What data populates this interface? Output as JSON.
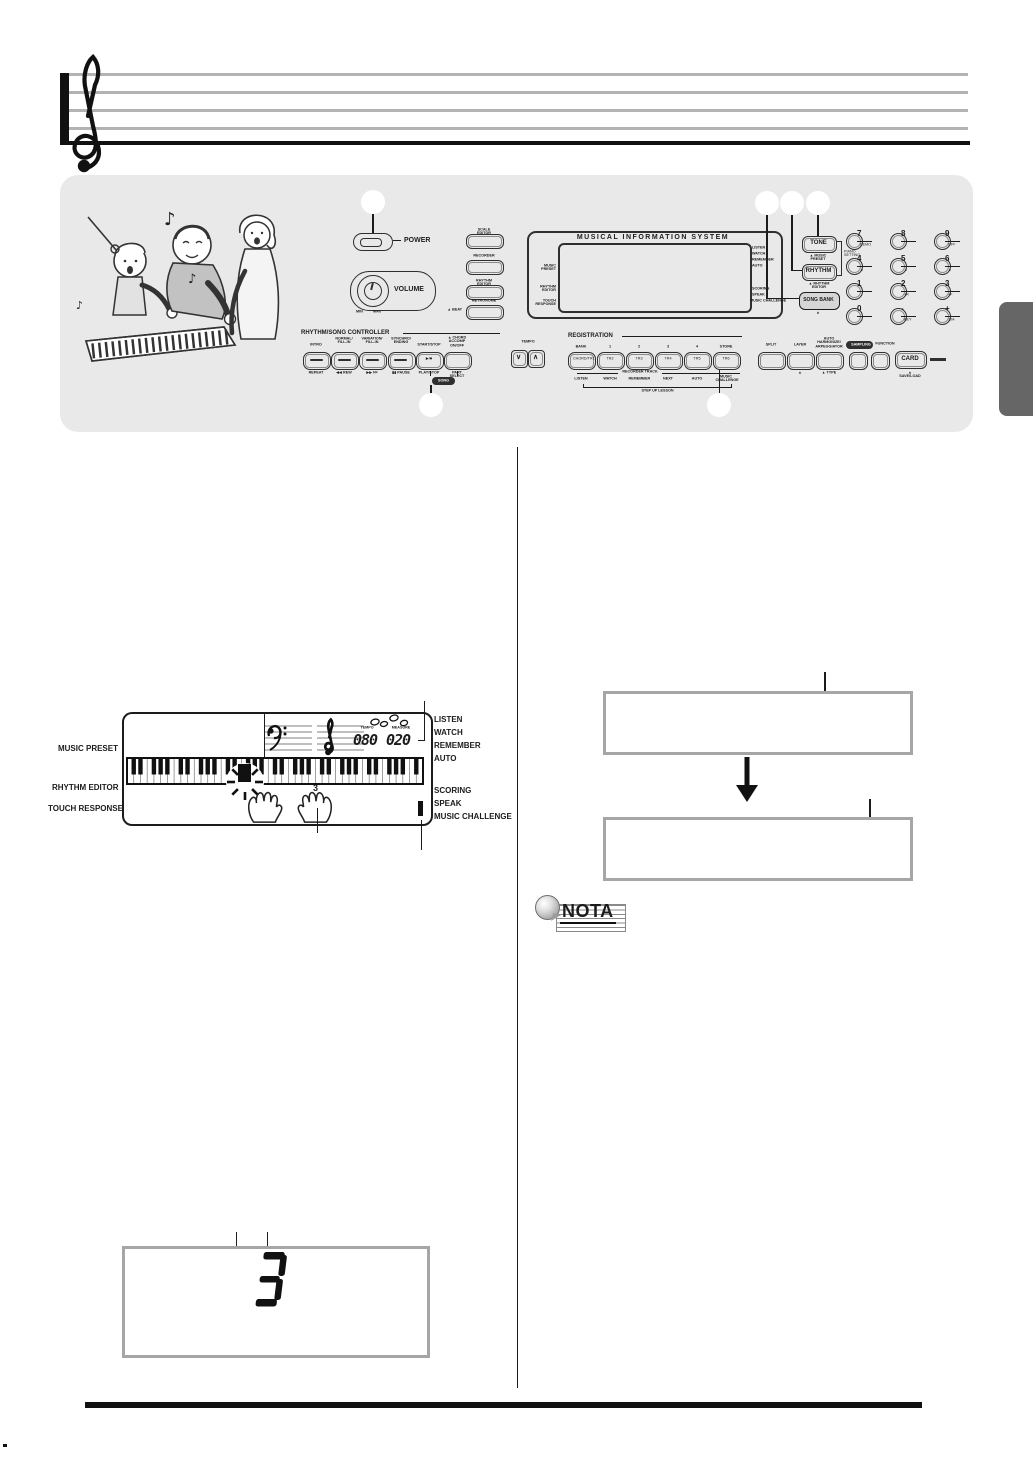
{
  "colors": {
    "panel_bg": "#e9e9e9",
    "side_tab": "#666666",
    "box_border": "#a6a6a6",
    "ink": "#1c1c1c"
  },
  "panel": {
    "power_label": "POWER",
    "volume": {
      "label": "VOLUME",
      "min": "MIN",
      "max": "MAX"
    },
    "side_buttons": [
      {
        "label": "SCALE EDITOR"
      },
      {
        "label": "RECORDER"
      },
      {
        "label": "RHYTHM EDITOR"
      },
      {
        "label": "METRONOME"
      }
    ],
    "beat_sub": "▲ BEAT",
    "display": {
      "title": "MUSICAL INFORMATION SYSTEM",
      "left_labels": [
        "MUSIC PRESET",
        "RHYTHM EDITOR",
        "TOUCH RESPONSE"
      ],
      "right_top_labels": [
        "LISTEN",
        "WATCH",
        "REMEMBER",
        "AUTO"
      ],
      "right_bottom_labels": [
        "SCORING",
        "SPEAK",
        "MUSIC CHALLENGE"
      ]
    },
    "tone": {
      "label": "TONE",
      "sub": "▲ MUSIC PRESET"
    },
    "rhythm": {
      "label": "RHYTHM",
      "sub": "▲ RHYTHM EDITOR"
    },
    "piano_setting": "PIANO\nSETTING",
    "song_bank": {
      "label": "SONG BANK",
      "sub": "▲"
    },
    "numpad": {
      "cells": [
        {
          "n": "7",
          "s": "DEMO"
        },
        {
          "n": "8",
          "s": ""
        },
        {
          "n": "9",
          "s": "OFF"
        },
        {
          "n": "4",
          "s": "▲"
        },
        {
          "n": "5",
          "s": "▲"
        },
        {
          "n": "6",
          "s": "▲"
        },
        {
          "n": "1",
          "s": ""
        },
        {
          "n": "2",
          "s": "+R"
        },
        {
          "n": "3",
          "s": "+F"
        },
        {
          "n": "0",
          "s": ""
        },
        {
          "n": "-",
          "s": "KEY"
        },
        {
          "n": "+",
          "s": "10A"
        }
      ]
    },
    "tempo": {
      "label": "TEMPO",
      "down": "∨",
      "up": "∧"
    },
    "controller": {
      "title": "RHYTHM/SONG CONTROLLER",
      "top_labels": [
        "INTRO",
        "NORMAL/\nFILL-IN",
        "VARIATION/\nFILL-IN",
        "SYNCHRO/\nENDING",
        "START/STOP",
        "▲ CHORD\nACCOMP ON/OFF"
      ],
      "bottom_labels": [
        "REPEAT",
        "◀◀ REW",
        "▶▶ FF",
        "▮▮ PAUSE",
        "PLAY/STOP",
        "PART SELECT"
      ],
      "play_glyph": "▶/■",
      "song_pill": "SONG"
    },
    "registration": {
      "title": "REGISTRATION",
      "top_labels": [
        "BANK",
        "1",
        "2",
        "3",
        "4",
        "STORE"
      ],
      "button_labels": [
        "CHORD/TR1",
        "TR2",
        "TR3",
        "TR4",
        "TR5",
        "TR6"
      ],
      "recorder_track": "RECORDER TRACK",
      "lesson_labels": [
        "LISTEN",
        "WATCH",
        "REMEMBER",
        "NEXT",
        "AUTO",
        "MUSIC\nCHALLENGE"
      ],
      "step_up": "STEP UP LESSON"
    },
    "right_group": {
      "split": "SPLIT",
      "layer": "LAYER",
      "harmonize": "AUTO HARMONIZE/\nARPEGGIATOR",
      "layer_sub": "▲",
      "type_sub": "▲ TYPE",
      "sampling": "SAMPLING",
      "function": "FUNCTION",
      "card": "CARD",
      "card_sub": "▲ SAVE/LOAD"
    }
  },
  "lcd_diagram": {
    "left_labels": [
      "MUSIC PRESET",
      "RHYTHM EDITOR",
      "TOUCH RESPONSE"
    ],
    "right_top_labels": [
      "LISTEN",
      "WATCH",
      "REMEMBER",
      "AUTO"
    ],
    "right_bottom_labels": [
      "SCORING",
      "SPEAK",
      "MUSIC CHALLENGE"
    ],
    "tempo_label": "TEMPO",
    "tempo_value": "080",
    "measure_label": "MEASURE",
    "measure_value": "020",
    "finger_number": "3"
  },
  "note_icon": {
    "label": "NOTA"
  },
  "bottom_display": {
    "value": "3"
  }
}
